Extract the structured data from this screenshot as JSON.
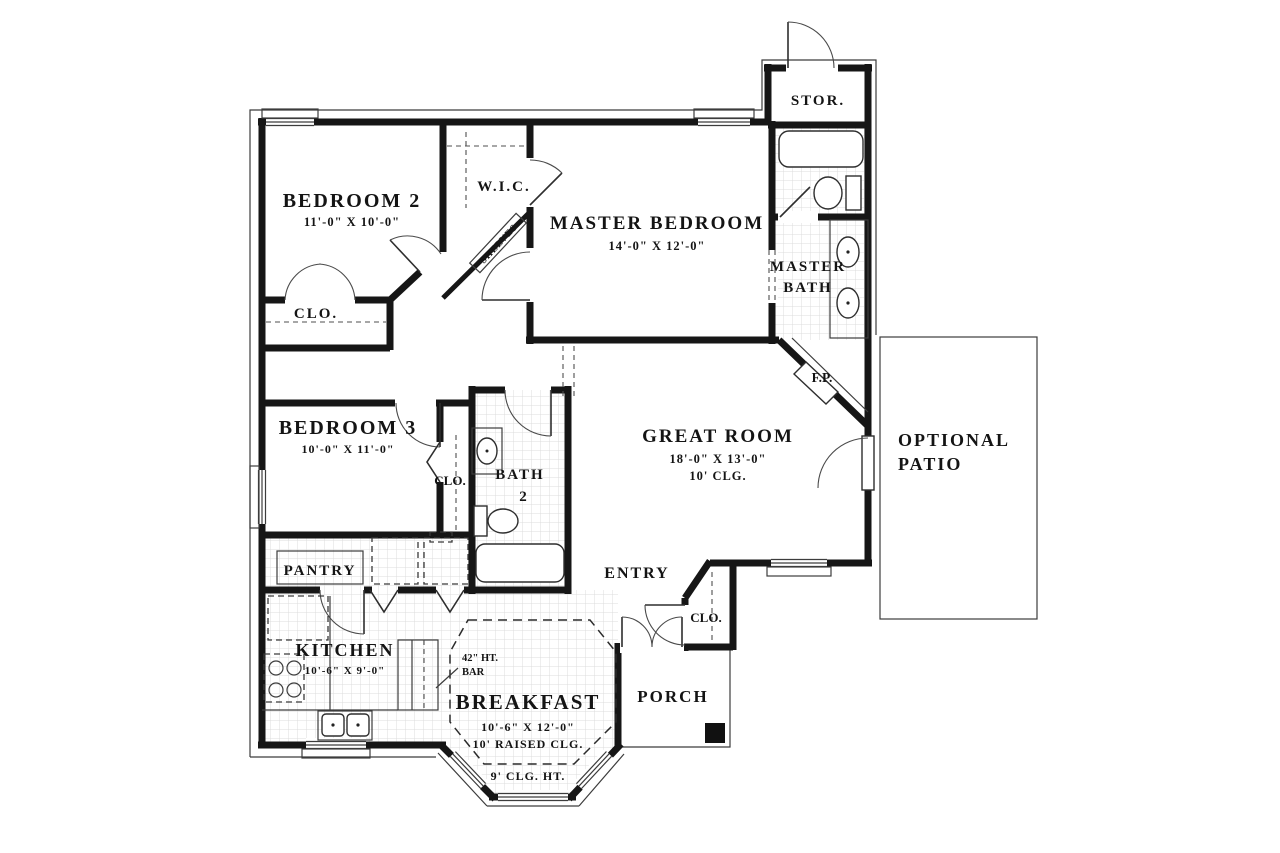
{
  "colors": {
    "wall": "#161616",
    "thin_line": "#3c3c3c",
    "tile_grid": "#d9d9d9",
    "background": "#ffffff"
  },
  "rooms": {
    "bedroom2": {
      "label": "BEDROOM 2",
      "dims": "11'-0\" X 10'-0\""
    },
    "bedroom3": {
      "label": "BEDROOM 3",
      "dims": "10'-0\" X 11'-0\""
    },
    "master_bedroom": {
      "label": "MASTER BEDROOM",
      "dims": "14'-0\" X 12'-0\""
    },
    "great_room": {
      "label": "GREAT ROOM",
      "dims": "18'-0\" X 13'-0\"",
      "ceiling": "10' CLG."
    },
    "kitchen": {
      "label": "KITCHEN",
      "dims": "10'-6\" X 9'-0\""
    },
    "breakfast": {
      "label": "BREAKFAST",
      "dims": "10'-6\" X 12'-0\"",
      "ceiling": "10' RAISED CLG.",
      "ceiling_note": "9' CLG. HT."
    },
    "wic": {
      "label": "W.I.C.",
      "shelves": "SHELVES"
    },
    "master_bath": {
      "label_line1": "MASTER",
      "label_line2": "BATH"
    },
    "bath2": {
      "label_line1": "BATH",
      "label_line2": "2"
    },
    "storage": {
      "label": "STOR."
    },
    "pantry": {
      "label": "PANTRY"
    },
    "entry": {
      "label": "ENTRY"
    },
    "porch": {
      "label": "PORCH"
    },
    "patio": {
      "label_line1": "OPTIONAL",
      "label_line2": "PATIO"
    },
    "fireplace": {
      "label": "F.P."
    },
    "closet_bedroom2": {
      "label": "CLO."
    },
    "closet_bedroom3": {
      "label": "CLO."
    },
    "closet_entry": {
      "label": "CLO."
    },
    "bar_note": {
      "line1": "42\" HT.",
      "line2": "BAR"
    }
  }
}
